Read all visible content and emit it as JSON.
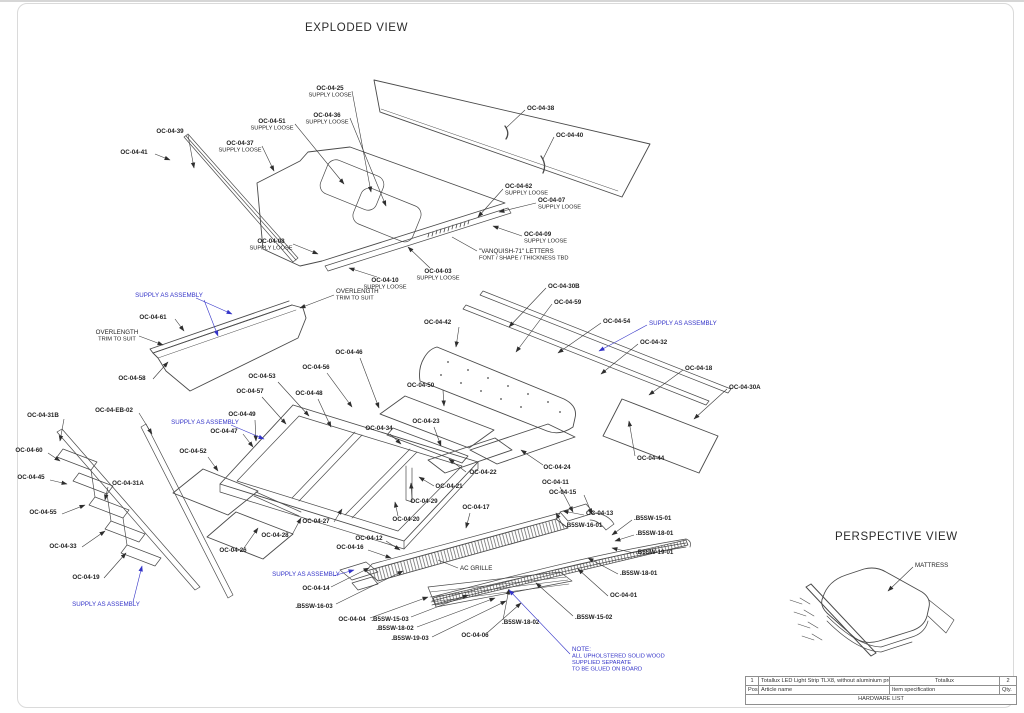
{
  "titles": {
    "exploded": "EXPLODED VIEW",
    "perspective": "PERSPECTIVE VIEW"
  },
  "colors": {
    "line": "#4a4a4a",
    "label": "#1f1f1f",
    "assembly_note": "#3434c8"
  },
  "callouts": [
    {
      "t": "OC-04-25",
      "s": "SUPPLY LOOSE",
      "x": 330,
      "y": 90,
      "a": "middle",
      "l": [
        [
          352,
          91,
          371,
          192
        ]
      ]
    },
    {
      "t": "OC-04-36",
      "s": "SUPPLY LOOSE",
      "x": 327,
      "y": 117,
      "a": "middle",
      "l": [
        [
          350,
          118,
          386,
          206
        ]
      ]
    },
    {
      "t": "OC-04-51",
      "s": "SUPPLY LOOSE",
      "x": 272,
      "y": 123,
      "a": "middle",
      "l": [
        [
          295,
          124,
          344,
          184
        ]
      ]
    },
    {
      "t": "OC-04-37",
      "s": "SUPPLY LOOSE",
      "x": 240,
      "y": 145,
      "a": "middle",
      "l": [
        [
          262,
          146,
          274,
          171
        ]
      ]
    },
    {
      "t": "OC-04-38",
      "x": 527,
      "y": 110,
      "a": "start",
      "l": [
        [
          525,
          110,
          506,
          128
        ]
      ],
      "p": 1
    },
    {
      "t": "OC-04-40",
      "x": 556,
      "y": 137,
      "a": "start",
      "l": [
        [
          554,
          137,
          543,
          159
        ]
      ],
      "p": 1
    },
    {
      "t": "OC-04-39",
      "x": 170,
      "y": 133,
      "a": "middle",
      "l": [
        [
          188,
          135,
          194,
          168
        ]
      ]
    },
    {
      "t": "OC-04-41",
      "x": 134,
      "y": 154,
      "a": "middle",
      "l": [
        [
          155,
          154,
          170,
          160
        ]
      ]
    },
    {
      "t": "OC-04-62",
      "s": "SUPPLY LOOSE",
      "x": 505,
      "y": 188,
      "a": "start",
      "l": [
        [
          503,
          189,
          478,
          217
        ]
      ]
    },
    {
      "t": "OC-04-07",
      "s": "SUPPLY LOOSE",
      "x": 538,
      "y": 202,
      "a": "start",
      "l": [
        [
          536,
          203,
          499,
          212
        ]
      ]
    },
    {
      "t": "OC-04-09",
      "s": "SUPPLY LOOSE",
      "x": 524,
      "y": 236,
      "a": "start",
      "l": [
        [
          522,
          236,
          493,
          226
        ]
      ]
    },
    {
      "t": "\"VANQUISH-71\" LETTERS",
      "s": "FONT / SHAPE / THICKNESS TBD",
      "x": 479,
      "y": 253,
      "a": "start",
      "r": 1,
      "p": 1,
      "l": [
        [
          477,
          251,
          452,
          237
        ]
      ]
    },
    {
      "t": "OC-04-08",
      "s": "SUPPLY LOOSE",
      "x": 271,
      "y": 243,
      "a": "middle",
      "l": [
        [
          293,
          244,
          318,
          254
        ]
      ]
    },
    {
      "t": "OC-04-10",
      "s": "SUPPLY LOOSE",
      "x": 385,
      "y": 282,
      "a": "middle",
      "l": [
        [
          377,
          277,
          349,
          268
        ]
      ]
    },
    {
      "t": "OC-04-03",
      "s": "SUPPLY LOOSE",
      "x": 438,
      "y": 273,
      "a": "middle",
      "l": [
        [
          430,
          268,
          408,
          247
        ]
      ]
    },
    {
      "t": "OC-04-30B",
      "x": 548,
      "y": 288,
      "a": "start",
      "l": [
        [
          546,
          288,
          509,
          327
        ]
      ]
    },
    {
      "t": "OC-04-59",
      "x": 554,
      "y": 304,
      "a": "start",
      "l": [
        [
          552,
          304,
          516,
          352
        ]
      ]
    },
    {
      "t": "OC-04-54",
      "x": 603,
      "y": 323,
      "a": "start",
      "l": [
        [
          601,
          323,
          558,
          353
        ]
      ]
    },
    {
      "t": "OC-04-32",
      "x": 640,
      "y": 344,
      "a": "start",
      "l": [
        [
          638,
          344,
          601,
          374
        ]
      ]
    },
    {
      "t": "OC-04-18",
      "x": 685,
      "y": 370,
      "a": "start",
      "l": [
        [
          683,
          370,
          649,
          395
        ]
      ]
    },
    {
      "t": "OC-04-30A",
      "x": 729,
      "y": 389,
      "a": "start",
      "l": [
        [
          727,
          389,
          694,
          419
        ]
      ]
    },
    {
      "t": "OC-04-42",
      "x": 424,
      "y": 324,
      "a": "start",
      "l": [
        [
          459,
          327,
          456,
          347
        ]
      ]
    },
    {
      "t": "OC-04-61",
      "x": 153,
      "y": 319,
      "a": "middle",
      "l": [
        [
          175,
          319,
          184,
          331
        ]
      ]
    },
    {
      "t": "OVERLENGTH",
      "s": "TRIM TO SUIT",
      "x": 336,
      "y": 293,
      "a": "start",
      "r": 1,
      "l": [
        [
          334,
          295,
          300,
          308
        ]
      ]
    },
    {
      "t": "OVERLENGTH",
      "s": "TRIM TO SUIT",
      "x": 117,
      "y": 334,
      "a": "middle",
      "r": 1,
      "l": [
        [
          139,
          336,
          163,
          345
        ]
      ]
    },
    {
      "t": "OC-04-58",
      "x": 132,
      "y": 380,
      "a": "middle",
      "l": [
        [
          153,
          379,
          168,
          362
        ]
      ]
    },
    {
      "t": "OC-04-46",
      "x": 349,
      "y": 354,
      "a": "middle",
      "l": [
        [
          360,
          358,
          379,
          408
        ]
      ]
    },
    {
      "t": "OC-04-56",
      "x": 316,
      "y": 369,
      "a": "middle",
      "l": [
        [
          327,
          373,
          352,
          407
        ]
      ]
    },
    {
      "t": "OC-04-53",
      "x": 262,
      "y": 378,
      "a": "middle",
      "l": [
        [
          278,
          382,
          309,
          416
        ]
      ]
    },
    {
      "t": "OC-04-57",
      "x": 250,
      "y": 393,
      "a": "middle",
      "l": [
        [
          262,
          397,
          286,
          424
        ]
      ]
    },
    {
      "t": "OC-04-48",
      "x": 309,
      "y": 395,
      "a": "middle",
      "l": [
        [
          318,
          399,
          331,
          427
        ]
      ]
    },
    {
      "t": "OC-04-50",
      "x": 407,
      "y": 387,
      "a": "start",
      "l": [
        [
          443,
          390,
          444,
          406
        ]
      ]
    },
    {
      "t": "OC-04-34",
      "x": 379,
      "y": 430,
      "a": "middle",
      "l": [
        [
          390,
          434,
          401,
          444
        ]
      ]
    },
    {
      "t": "OC-04-23",
      "x": 426,
      "y": 423,
      "a": "middle",
      "l": [
        [
          434,
          427,
          441,
          446
        ]
      ]
    },
    {
      "t": "OC-04-49",
      "x": 242,
      "y": 416,
      "a": "middle",
      "l": [
        [
          255,
          420,
          256,
          441
        ]
      ]
    },
    {
      "t": "OC-04-47",
      "x": 224,
      "y": 433,
      "a": "middle",
      "l": [
        [
          243,
          434,
          253,
          447
        ]
      ]
    },
    {
      "t": "OC-04-52",
      "x": 193,
      "y": 453,
      "a": "middle",
      "l": [
        [
          208,
          457,
          218,
          471
        ]
      ]
    },
    {
      "t": "OC-04-EB-02",
      "x": 114,
      "y": 412,
      "a": "middle",
      "l": [
        [
          139,
          413,
          152,
          434
        ]
      ]
    },
    {
      "t": "OC-04-31B",
      "x": 43,
      "y": 417,
      "a": "middle",
      "l": [
        [
          64,
          419,
          60,
          441
        ]
      ]
    },
    {
      "t": "OC-04-60",
      "x": 29,
      "y": 452,
      "a": "middle",
      "l": [
        [
          48,
          453,
          60,
          461
        ]
      ]
    },
    {
      "t": "OC-04-45",
      "x": 31,
      "y": 479,
      "a": "middle",
      "l": [
        [
          50,
          480,
          67,
          484
        ]
      ]
    },
    {
      "t": "OC-04-31A",
      "x": 128,
      "y": 485,
      "a": "middle",
      "l": [
        [
          108,
          487,
          105,
          500
        ]
      ]
    },
    {
      "t": "OC-04-55",
      "x": 43,
      "y": 514,
      "a": "middle",
      "l": [
        [
          62,
          514,
          85,
          505
        ]
      ]
    },
    {
      "t": "OC-04-33",
      "x": 63,
      "y": 548,
      "a": "middle",
      "l": [
        [
          82,
          547,
          105,
          531
        ]
      ]
    },
    {
      "t": "OC-04-19",
      "x": 86,
      "y": 579,
      "a": "middle",
      "l": [
        [
          104,
          578,
          126,
          553
        ]
      ]
    },
    {
      "t": "OC-04-26",
      "x": 233,
      "y": 552,
      "a": "middle",
      "l": [
        [
          244,
          548,
          258,
          528
        ]
      ]
    },
    {
      "t": "OC-04-27",
      "x": 316,
      "y": 523,
      "a": "middle",
      "l": [
        [
          334,
          522,
          342,
          509
        ]
      ]
    },
    {
      "t": "OC-04-28",
      "x": 275,
      "y": 537,
      "a": "middle",
      "l": [
        [
          292,
          535,
          301,
          518
        ]
      ]
    },
    {
      "t": "OC-04-20",
      "x": 406,
      "y": 521,
      "a": "middle",
      "l": [
        [
          398,
          516,
          395,
          502
        ]
      ]
    },
    {
      "t": "OC-04-29",
      "x": 424,
      "y": 503,
      "a": "middle",
      "l": [
        [
          412,
          499,
          411,
          483
        ]
      ]
    },
    {
      "t": "OC-04-21",
      "x": 449,
      "y": 488,
      "a": "middle",
      "l": [
        [
          434,
          486,
          419,
          477
        ]
      ]
    },
    {
      "t": "OC-04-22",
      "x": 483,
      "y": 474,
      "a": "middle",
      "l": [
        [
          466,
          472,
          449,
          459
        ]
      ]
    },
    {
      "t": "OC-04-24",
      "x": 557,
      "y": 469,
      "a": "middle",
      "l": [
        [
          543,
          465,
          521,
          450
        ]
      ]
    },
    {
      "t": "OC-04-44",
      "x": 637,
      "y": 460,
      "a": "start",
      "l": [
        [
          635,
          456,
          629,
          421
        ]
      ]
    },
    {
      "t": "OC-04-11",
      "x": 542,
      "y": 484,
      "a": "start",
      "l": [
        [
          560,
          487,
          573,
          512
        ]
      ]
    },
    {
      "t": "OC-04-15",
      "x": 549,
      "y": 494,
      "a": "start",
      "l": [
        [
          584,
          495,
          592,
          514
        ]
      ]
    },
    {
      "t": "OC-04-13",
      "x": 586,
      "y": 515,
      "a": "start",
      "l": [
        [
          584,
          515,
          563,
          511
        ]
      ]
    },
    {
      "t": "OC-04-17",
      "x": 476,
      "y": 509,
      "a": "middle",
      "l": [
        [
          470,
          513,
          466,
          528
        ]
      ]
    },
    {
      "t": ".B5SW-16-01",
      "x": 565,
      "y": 527,
      "a": "start",
      "l": [
        [
          563,
          526,
          556,
          513
        ]
      ]
    },
    {
      "t": ".B5SW-15-01",
      "x": 634,
      "y": 520,
      "a": "start",
      "l": [
        [
          632,
          520,
          612,
          535
        ]
      ]
    },
    {
      "t": ".B5SW-18-01",
      "x": 636,
      "y": 535,
      "a": "start",
      "l": [
        [
          634,
          535,
          615,
          541
        ]
      ]
    },
    {
      "t": ".B5SW-19-01",
      "x": 636,
      "y": 554,
      "a": "start",
      "l": [
        [
          634,
          553,
          612,
          548
        ]
      ]
    },
    {
      "t": ".B5SW-18-01",
      "x": 620,
      "y": 575,
      "a": "start",
      "l": [
        [
          618,
          574,
          588,
          558
        ]
      ]
    },
    {
      "t": "OC-04-01",
      "x": 610,
      "y": 597,
      "a": "start",
      "l": [
        [
          608,
          596,
          578,
          569
        ]
      ]
    },
    {
      "t": "OC-04-12",
      "x": 369,
      "y": 540,
      "a": "middle",
      "l": [
        [
          386,
          541,
          400,
          550
        ]
      ]
    },
    {
      "t": "OC-04-16",
      "x": 350,
      "y": 549,
      "a": "middle",
      "l": [
        [
          368,
          550,
          391,
          558
        ]
      ]
    },
    {
      "t": "AC GRILLE",
      "x": 460,
      "y": 570,
      "a": "start",
      "r": 1,
      "p": 1,
      "l": [
        [
          458,
          568,
          438,
          560
        ]
      ]
    },
    {
      "t": "OC-04-14",
      "x": 316,
      "y": 590,
      "a": "middle",
      "l": [
        [
          331,
          587,
          369,
          568
        ]
      ]
    },
    {
      "t": ".B5SW-16-03",
      "x": 314,
      "y": 608,
      "a": "middle",
      "l": [
        [
          336,
          604,
          403,
          571
        ]
      ]
    },
    {
      "t": "OC-04-04",
      "x": 352,
      "y": 621,
      "a": "middle",
      "l": [
        [
          370,
          618,
          428,
          597
        ]
      ]
    },
    {
      "t": ".B5SW-15-03",
      "x": 390,
      "y": 621,
      "a": "middle",
      "l": [
        [
          411,
          617,
          468,
          595
        ]
      ]
    },
    {
      "t": ".B5SW-18-02",
      "x": 395,
      "y": 630,
      "a": "middle",
      "l": [
        [
          417,
          627,
          495,
          598
        ]
      ]
    },
    {
      "t": ".B5SW-19-03",
      "x": 410,
      "y": 640,
      "a": "middle",
      "l": [
        [
          432,
          637,
          506,
          601
        ]
      ]
    },
    {
      "t": "OC-04-06",
      "x": 475,
      "y": 637,
      "a": "middle",
      "l": [
        [
          487,
          633,
          521,
          603
        ]
      ]
    },
    {
      "t": ".B5SW-18-02",
      "x": 502,
      "y": 624,
      "a": "start",
      "l": [
        [
          503,
          620,
          509,
          589
        ]
      ]
    },
    {
      "t": ".B5SW-15-02",
      "x": 575,
      "y": 619,
      "a": "start",
      "l": [
        [
          573,
          616,
          536,
          583
        ]
      ]
    },
    {
      "t": "SUPPLY AS ASSEMBLY",
      "x": 169,
      "y": 297,
      "a": "middle",
      "c": "b",
      "l": [
        [
          196,
          298,
          232,
          314
        ],
        [
          204,
          300,
          218,
          336
        ]
      ]
    },
    {
      "t": "SUPPLY AS ASSEMBLY",
      "x": 205,
      "y": 424,
      "a": "middle",
      "c": "b",
      "l": [
        [
          231,
          425,
          264,
          439
        ]
      ]
    },
    {
      "t": "SUPPLY AS ASSEMBLY",
      "x": 649,
      "y": 325,
      "a": "start",
      "c": "b",
      "l": [
        [
          647,
          325,
          599,
          351
        ]
      ]
    },
    {
      "t": "SUPPLY AS ASSEMBLY",
      "x": 106,
      "y": 606,
      "a": "middle",
      "c": "b",
      "l": [
        [
          133,
          602,
          142,
          566
        ]
      ]
    },
    {
      "t": "SUPPLY AS ASSEMBLY",
      "x": 306,
      "y": 576,
      "a": "middle",
      "c": "b",
      "l": [
        [
          333,
          576,
          354,
          570
        ]
      ]
    },
    {
      "t": "NOTE:",
      "s": [
        "ALL UPHOLSTERED SOLID WOOD",
        "SUPPLIED SEPARATE",
        "TO BE GLUED ON BOARD"
      ],
      "x": 572,
      "y": 651,
      "a": "start",
      "c": "b",
      "l": [
        [
          570,
          654,
          509,
          590
        ]
      ]
    },
    {
      "t": "MATTRESS",
      "x": 915,
      "y": 567,
      "a": "start",
      "r": 1,
      "l": [
        [
          913,
          567,
          888,
          591
        ]
      ]
    }
  ],
  "hardware_table": {
    "title": "HARDWARE LIST",
    "columns": [
      "Pos.",
      "Article name",
      "Item specification",
      "Qty."
    ],
    "rows": [
      [
        "1",
        "Totallux LED Light Strip TLX8, without aluminium profile",
        "Totallux",
        "2"
      ]
    ]
  }
}
